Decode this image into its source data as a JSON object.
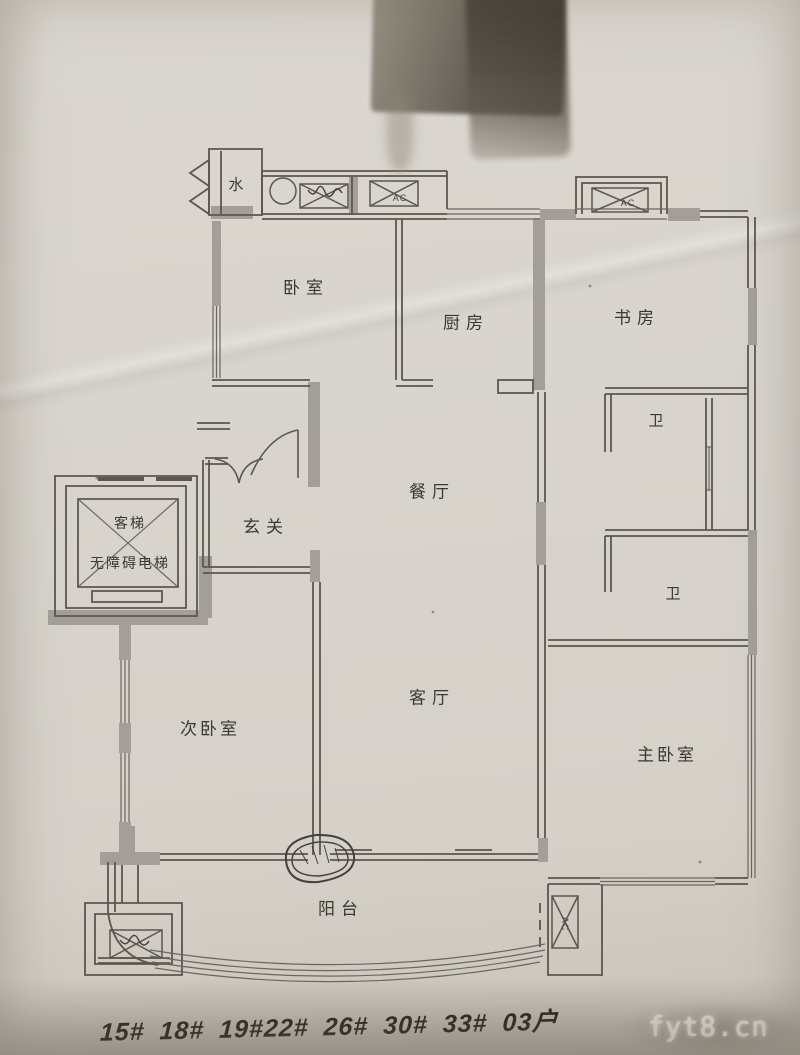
{
  "photo": {
    "description": "photographed architectural floor plan sketch",
    "colors": {
      "paper": "#d8d4cd",
      "line": "#5b574f",
      "wall_fill": "#a39f98",
      "handwriting_ink": "#2b2823",
      "watermark_text": "#d5d1c9",
      "tape_stain": "#55504a"
    }
  },
  "rooms": {
    "water": {
      "label": "水"
    },
    "bedroom": {
      "label": "卧室"
    },
    "kitchen": {
      "label": "厨房"
    },
    "study": {
      "label": "书房"
    },
    "bath_upper": {
      "label": "卫"
    },
    "dining": {
      "label": "餐厅"
    },
    "foyer": {
      "label": "玄关"
    },
    "elevator": {
      "label": "客梯"
    },
    "accessible_elevator": {
      "label": "无障碍电梯"
    },
    "bath_lower": {
      "label": "卫"
    },
    "second_bedroom": {
      "label": "次卧室"
    },
    "living": {
      "label": "客厅"
    },
    "master_bedroom": {
      "label": "主卧室"
    },
    "balcony": {
      "label": "阳台"
    }
  },
  "equipment": {
    "ac_unit_label": "AC"
  },
  "annotations": {
    "handwritten_building_numbers": "15# 18# 19#22# 26# 30# 33# 03户"
  },
  "watermark": {
    "text": "fyt8.cn"
  }
}
